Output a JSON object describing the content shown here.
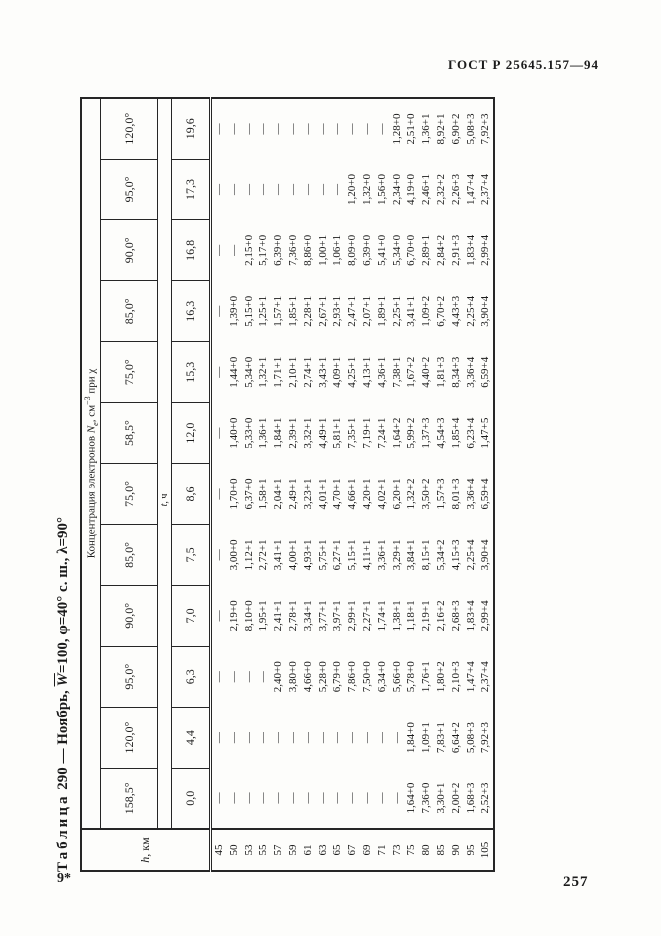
{
  "page": {
    "header_right": "ГОСТ Р 25645.157—94",
    "footer_left": "9*",
    "footer_right": "257"
  },
  "table": {
    "title": {
      "word1": "Таблица",
      "t2": " 290 — Ноябрь, ",
      "w": "W",
      "t3": "=100, φ=40° с. ш., λ=90°"
    },
    "corner": {
      "italic": "h",
      "rest": ", км"
    },
    "span_header": {
      "p1": "Концентрация электронов ",
      "n": "N",
      "n_sub": "e",
      "p2": ", см",
      "sup": "−3",
      "p3": " при χ"
    },
    "t_label": {
      "italic": "t",
      "rest": ", ч"
    },
    "chi_values": [
      "158,5°",
      "120,0°",
      "95,0°",
      "90,0°",
      "85,0°",
      "75,0°",
      "58,5°",
      "75,0°",
      "85,0°",
      "90,0°",
      "95,0°",
      "120,0°"
    ],
    "t_values": [
      "0,0",
      "4,4",
      "6,3",
      "7,0",
      "7,5",
      "8,6",
      "12,0",
      "15,3",
      "16,3",
      "16,8",
      "17,3",
      "19,6"
    ],
    "h_values": [
      "45",
      "50",
      "53",
      "55",
      "57",
      "59",
      "61",
      "63",
      "65",
      "67",
      "69",
      "71",
      "73",
      "75",
      "80",
      "85",
      "90",
      "95",
      "105"
    ],
    "rows": [
      [
        "—",
        "—",
        "—",
        "—",
        "—",
        "—",
        "—",
        "—",
        "—",
        "—",
        "—",
        "—"
      ],
      [
        "—",
        "—",
        "—",
        "2,19+0",
        "3,00+0",
        "1,70+0",
        "1,40+0",
        "1,44+0",
        "1,39+0",
        "—",
        "—",
        "—"
      ],
      [
        "—",
        "—",
        "—",
        "8,10+0",
        "1,12+1",
        "6,37+0",
        "5,33+0",
        "5,34+0",
        "5,15+0",
        "2,15+0",
        "—",
        "—"
      ],
      [
        "—",
        "—",
        "—",
        "1,95+1",
        "2,72+1",
        "1,58+1",
        "1,36+1",
        "1,32+1",
        "1,25+1",
        "5,17+0",
        "—",
        "—"
      ],
      [
        "—",
        "—",
        "2,40+0",
        "2,41+1",
        "3,41+1",
        "2,04+1",
        "1,84+1",
        "1,71+1",
        "1,57+1",
        "6,39+0",
        "—",
        "—"
      ],
      [
        "—",
        "—",
        "3,80+0",
        "2,78+1",
        "4,00+1",
        "2,49+1",
        "2,39+1",
        "2,10+1",
        "1,85+1",
        "7,36+0",
        "—",
        "—"
      ],
      [
        "—",
        "—",
        "4,66+0",
        "3,34+1",
        "4,93+1",
        "3,23+1",
        "3,32+1",
        "2,74+1",
        "2,28+1",
        "8,86+0",
        "—",
        "—"
      ],
      [
        "—",
        "—",
        "5,28+0",
        "3,77+1",
        "5,75+1",
        "4,01+1",
        "4,49+1",
        "3,43+1",
        "2,67+1",
        "1,00+1",
        "—",
        "—"
      ],
      [
        "—",
        "—",
        "6,79+0",
        "3,97+1",
        "6,27+1",
        "4,70+1",
        "5,81+1",
        "4,09+1",
        "2,93+1",
        "1,06+1",
        "—",
        "—"
      ],
      [
        "—",
        "—",
        "7,86+0",
        "2,99+1",
        "5,15+1",
        "4,66+1",
        "7,35+1",
        "4,25+1",
        "2,47+1",
        "8,09+0",
        "1,20+0",
        "—"
      ],
      [
        "—",
        "—",
        "7,50+0",
        "2,27+1",
        "4,11+1",
        "4,20+1",
        "7,19+1",
        "4,13+1",
        "2,07+1",
        "6,39+0",
        "1,32+0",
        "—"
      ],
      [
        "—",
        "—",
        "6,34+0",
        "1,74+1",
        "3,36+1",
        "4,02+1",
        "7,24+1",
        "4,36+1",
        "1,89+1",
        "5,41+0",
        "1,56+0",
        "—"
      ],
      [
        "—",
        "—",
        "5,66+0",
        "1,38+1",
        "3,29+1",
        "6,20+1",
        "1,64+2",
        "7,38+1",
        "2,25+1",
        "5,34+0",
        "2,34+0",
        "1,28+0"
      ],
      [
        "1,64+0",
        "1,84+0",
        "5,78+0",
        "1,18+1",
        "3,84+1",
        "1,32+2",
        "5,99+2",
        "1,67+2",
        "3,41+1",
        "6,70+0",
        "4,19+0",
        "2,51+0"
      ],
      [
        "7,36+0",
        "1,09+1",
        "1,76+1",
        "2,19+1",
        "8,15+1",
        "3,50+2",
        "1,37+3",
        "4,40+2",
        "1,09+2",
        "2,89+1",
        "2,46+1",
        "1,36+1"
      ],
      [
        "3,30+1",
        "7,83+1",
        "1,80+2",
        "2,16+2",
        "5,34+2",
        "1,57+3",
        "4,54+3",
        "1,81+3",
        "6,70+2",
        "2,84+2",
        "2,32+2",
        "8,92+1"
      ],
      [
        "2,00+2",
        "6,64+2",
        "2,10+3",
        "2,68+3",
        "4,15+3",
        "8,01+3",
        "1,85+4",
        "8,34+3",
        "4,43+3",
        "2,91+3",
        "2,26+3",
        "6,90+2"
      ],
      [
        "1,68+3",
        "5,08+3",
        "1,47+4",
        "1,83+4",
        "2,25+4",
        "3,36+4",
        "6,23+4",
        "3,36+4",
        "2,25+4",
        "1,83+4",
        "1,47+4",
        "5,08+3"
      ],
      [
        "2,52+3",
        "7,92+3",
        "2,37+4",
        "2,99+4",
        "3,90+4",
        "6,59+4",
        "1,47+5",
        "6,59+4",
        "3,90+4",
        "2,99+4",
        "2,37+4",
        "7,92+3"
      ]
    ]
  }
}
